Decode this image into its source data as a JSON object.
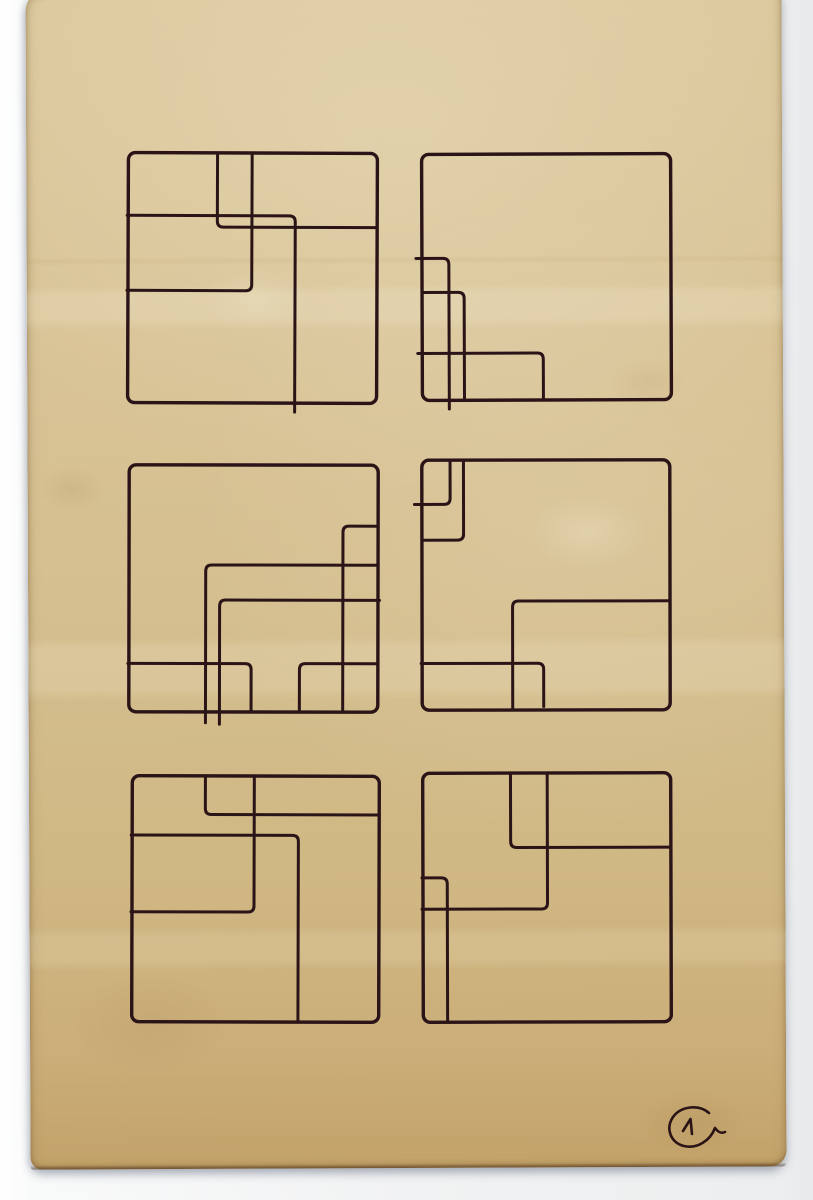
{
  "palette": {
    "background": "#f1f2f3",
    "paper_top": "#dcc99e",
    "paper_bottom": "#c2a269",
    "ink": "#2b1417"
  },
  "artwork": {
    "ink_color": "#2b1417",
    "frame_stroke_width": 3.4,
    "line_stroke_width": 3.0,
    "corner_radius": 6,
    "panels": [
      {
        "name": "top-left",
        "frame": {
          "x": 128,
          "y": 153,
          "w": 249,
          "h": 250
        },
        "tilt": 0.2,
        "lines": [
          [
            [
              0.358,
              0
            ],
            [
              0.358,
              0.297
            ],
            [
              1.0,
              0.297
            ]
          ],
          [
            [
              -0.004,
              0.251
            ],
            [
              0.671,
              0.251
            ],
            [
              0.671,
              1.036
            ]
          ],
          [
            [
              0.497,
              0
            ],
            [
              0.497,
              0.551
            ],
            [
              -0.004,
              0.551
            ]
          ]
        ]
      },
      {
        "name": "top-right",
        "frame": {
          "x": 422,
          "y": 154,
          "w": 249,
          "h": 246
        },
        "tilt": -0.2,
        "lines": [
          [
            [
              -0.024,
              0.423
            ],
            [
              0.108,
              0.423
            ],
            [
              0.108,
              1.035
            ]
          ],
          [
            [
              0.004,
              0.561
            ],
            [
              0.169,
              0.561
            ],
            [
              0.169,
              0.992
            ]
          ],
          [
            [
              -0.018,
              0.809
            ],
            [
              0.486,
              0.809
            ],
            [
              0.486,
              0.996
            ]
          ]
        ]
      },
      {
        "name": "middle-left",
        "frame": {
          "x": 129,
          "y": 465,
          "w": 249,
          "h": 247
        },
        "tilt": 0.1,
        "lines": [
          [
            [
              1.0,
              0.247
            ],
            [
              0.859,
              0.247
            ],
            [
              0.859,
              1.0
            ]
          ],
          [
            [
              1.0,
              0.405
            ],
            [
              0.308,
              0.405
            ],
            [
              0.308,
              1.044
            ]
          ],
          [
            [
              1.006,
              0.547
            ],
            [
              0.364,
              0.547
            ],
            [
              0.364,
              1.05
            ]
          ],
          [
            [
              -0.004,
              0.804
            ],
            [
              0.491,
              0.804
            ],
            [
              0.491,
              0.996
            ]
          ],
          [
            [
              0.685,
              0.996
            ],
            [
              0.685,
              0.804
            ],
            [
              1.0,
              0.804
            ]
          ]
        ]
      },
      {
        "name": "middle-right",
        "frame": {
          "x": 422,
          "y": 460,
          "w": 248,
          "h": 250
        },
        "tilt": -0.1,
        "lines": [
          [
            [
              0.114,
              0
            ],
            [
              0.114,
              0.177
            ],
            [
              -0.03,
              0.177
            ]
          ],
          [
            [
              0.168,
              0
            ],
            [
              0.168,
              0.32
            ],
            [
              0.004,
              0.32
            ]
          ],
          [
            [
              0.365,
              0.994
            ],
            [
              0.365,
              0.564
            ],
            [
              1.0,
              0.564
            ]
          ],
          [
            [
              -0.004,
              0.813
            ],
            [
              0.49,
              0.813
            ],
            [
              0.49,
              0.986
            ]
          ]
        ]
      },
      {
        "name": "bottom-left",
        "frame": {
          "x": 132,
          "y": 776,
          "w": 247,
          "h": 246
        },
        "tilt": 0.15,
        "lines": [
          [
            [
              0.296,
              0
            ],
            [
              0.296,
              0.157
            ],
            [
              1.0,
              0.157
            ]
          ],
          [
            [
              0.494,
              0
            ],
            [
              0.494,
              0.553
            ],
            [
              -0.004,
              0.553
            ]
          ],
          [
            [
              -0.004,
              0.241
            ],
            [
              0.673,
              0.241
            ],
            [
              0.673,
              0.998
            ]
          ]
        ]
      },
      {
        "name": "bottom-right",
        "frame": {
          "x": 423,
          "y": 773,
          "w": 248,
          "h": 249
        },
        "tilt": -0.15,
        "lines": [
          [
            [
              0.354,
              0
            ],
            [
              0.354,
              0.299
            ],
            [
              1.0,
              0.299
            ]
          ],
          [
            [
              0.502,
              0
            ],
            [
              0.502,
              0.546
            ],
            [
              -0.004,
              0.546
            ]
          ],
          [
            [
              -0.004,
              0.42
            ],
            [
              0.098,
              0.42
            ],
            [
              0.098,
              0.994
            ]
          ]
        ]
      }
    ],
    "annotation": {
      "symbol": "1",
      "description": "handwritten circled numeral one, bottom-right corner",
      "stroke_width": 2.6,
      "paths": [
        "M 709 1113 C 699 1104 681 1106 673 1117 C 665 1129 671 1143 684 1146 C 697 1149 710 1141 715 1128 C 718 1132 721 1134 725 1132",
        "M 683 1131 L 690.5 1119 L 692 1134"
      ]
    }
  }
}
